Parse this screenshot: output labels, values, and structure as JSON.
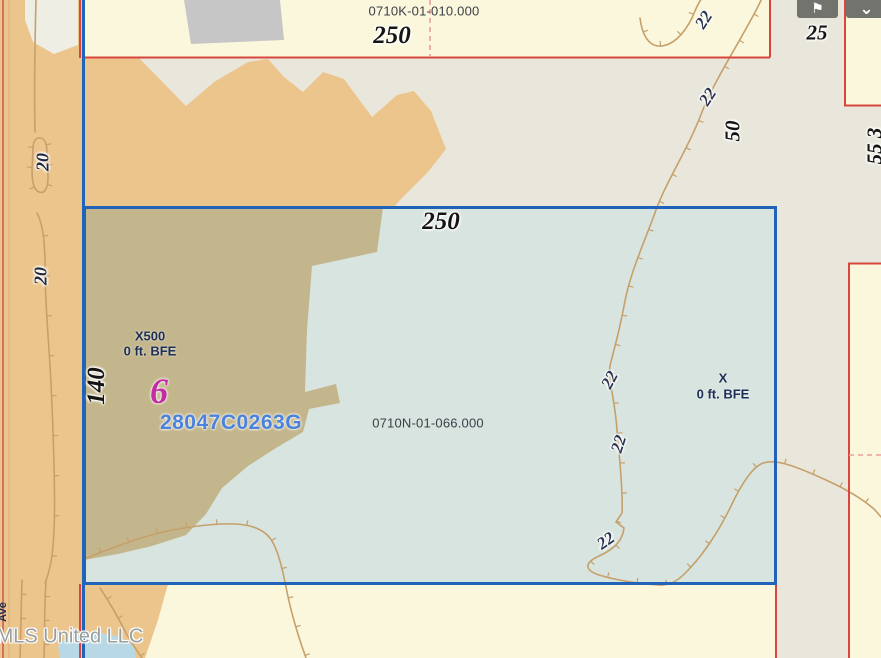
{
  "colors": {
    "base": "#e9e7db",
    "yellow": "#fbf7dc",
    "tan": "#ecc58d",
    "olive": "#c4b68c",
    "parcel_fill": "#d8e4df",
    "blue": "#2063b8",
    "red": "#d9463e",
    "contour": "#c6a06b",
    "building": "#c6c6c6",
    "pond": "#b9d8e6",
    "pink_dash": "#eb9f9f",
    "gray_blob": "#efeee4",
    "road": "#d4705f",
    "magenta": "#c32ba4",
    "firm_blue": "#4a82dc",
    "button": "#73736d"
  },
  "toolbar": {
    "buttons": [
      {
        "icon": "pin-icon",
        "glyph": "⚑"
      },
      {
        "icon": "chevron-down-icon",
        "glyph": "⌄"
      }
    ]
  },
  "map": {
    "watermark": "MLS United LLC",
    "parcels": {
      "top": {
        "id": "0710K-01-010.000",
        "frontage": "250"
      },
      "main": {
        "id": "0710N-01-066.000",
        "frontage": "250",
        "side": "140"
      },
      "right": {
        "number": "25"
      }
    },
    "flood": {
      "panel": "28047C0263G",
      "zone_left": "X500",
      "zone_left_bfe": "0 ft. BFE",
      "zone_right": "X",
      "zone_right_bfe": "0 ft. BFE",
      "zone_number": "6"
    },
    "contour_elevations": [
      "20",
      "22",
      "50",
      "55 3"
    ],
    "labels": [
      {
        "text": "0710K-01-010.000",
        "x": 424,
        "y": 11,
        "rot": 0,
        "cls": "sans-id",
        "name": "parcel-id-top"
      },
      {
        "text": "250",
        "x": 392,
        "y": 36,
        "rot": 0,
        "cls": "serif-lg",
        "name": "dim-250-top"
      },
      {
        "text": "25",
        "x": 817,
        "y": 33,
        "rot": 0,
        "cls": "serif-md",
        "name": "dim-25"
      },
      {
        "text": "55 3",
        "x": 875,
        "y": 146,
        "rot": -90,
        "cls": "serif-md",
        "name": "dim-55-clipped"
      },
      {
        "text": "20",
        "x": 43,
        "y": 162,
        "rot": -90,
        "cls": "serif-sm",
        "name": "contour-20-a"
      },
      {
        "text": "20",
        "x": 41,
        "y": 276,
        "rot": -90,
        "cls": "serif-sm",
        "name": "contour-20-b"
      },
      {
        "text": "140",
        "x": 97,
        "y": 386,
        "rot": -90,
        "cls": "serif-lg",
        "name": "dim-140"
      },
      {
        "text": "50",
        "x": 733,
        "y": 131,
        "rot": -90,
        "cls": "serif-md",
        "name": "dim-50"
      },
      {
        "text": "250",
        "x": 441,
        "y": 222,
        "rot": 0,
        "cls": "serif-lg",
        "name": "dim-250-main"
      },
      {
        "text": "22",
        "x": 704,
        "y": 20,
        "rot": -57,
        "cls": "serif-ct",
        "name": "contour-22-1"
      },
      {
        "text": "22",
        "x": 708,
        "y": 97,
        "rot": -57,
        "cls": "serif-ct",
        "name": "contour-22-2"
      },
      {
        "text": "22",
        "x": 610,
        "y": 380,
        "rot": -62,
        "cls": "serif-ct",
        "name": "contour-22-3"
      },
      {
        "text": "22",
        "x": 619,
        "y": 444,
        "rot": -72,
        "cls": "serif-ct",
        "name": "contour-22-4"
      },
      {
        "text": "22",
        "x": 606,
        "y": 541,
        "rot": -35,
        "cls": "serif-ct",
        "name": "contour-22-5"
      },
      {
        "text": "X500",
        "x": 150,
        "y": 336,
        "rot": 0,
        "cls": "zone",
        "name": "flood-zone-x500"
      },
      {
        "text": "0 ft. BFE",
        "x": 150,
        "y": 351,
        "rot": 0,
        "cls": "zone",
        "name": "flood-zone-x500-bfe"
      },
      {
        "text": "6",
        "x": 159,
        "y": 391,
        "rot": 0,
        "cls": "six",
        "name": "zone-number-6"
      },
      {
        "text": "28047C0263G",
        "x": 231,
        "y": 423,
        "rot": 0,
        "cls": "firm",
        "name": "firm-panel-id"
      },
      {
        "text": "0710N-01-066.000",
        "x": 428,
        "y": 423,
        "rot": 0,
        "cls": "sans-id",
        "name": "parcel-id-main"
      },
      {
        "text": "X",
        "x": 723,
        "y": 378,
        "rot": 0,
        "cls": "zone",
        "name": "flood-zone-x"
      },
      {
        "text": "0 ft. BFE",
        "x": 723,
        "y": 394,
        "rot": 0,
        "cls": "zone",
        "name": "flood-zone-x-bfe"
      },
      {
        "text": "Ave",
        "x": 3,
        "y": 612,
        "rot": -90,
        "cls": "frag",
        "name": "street-label-fragment"
      },
      {
        "text": "MLS United LLC",
        "x": 70,
        "y": 637,
        "rot": 0,
        "cls": "watermark",
        "name": "watermark"
      }
    ]
  }
}
